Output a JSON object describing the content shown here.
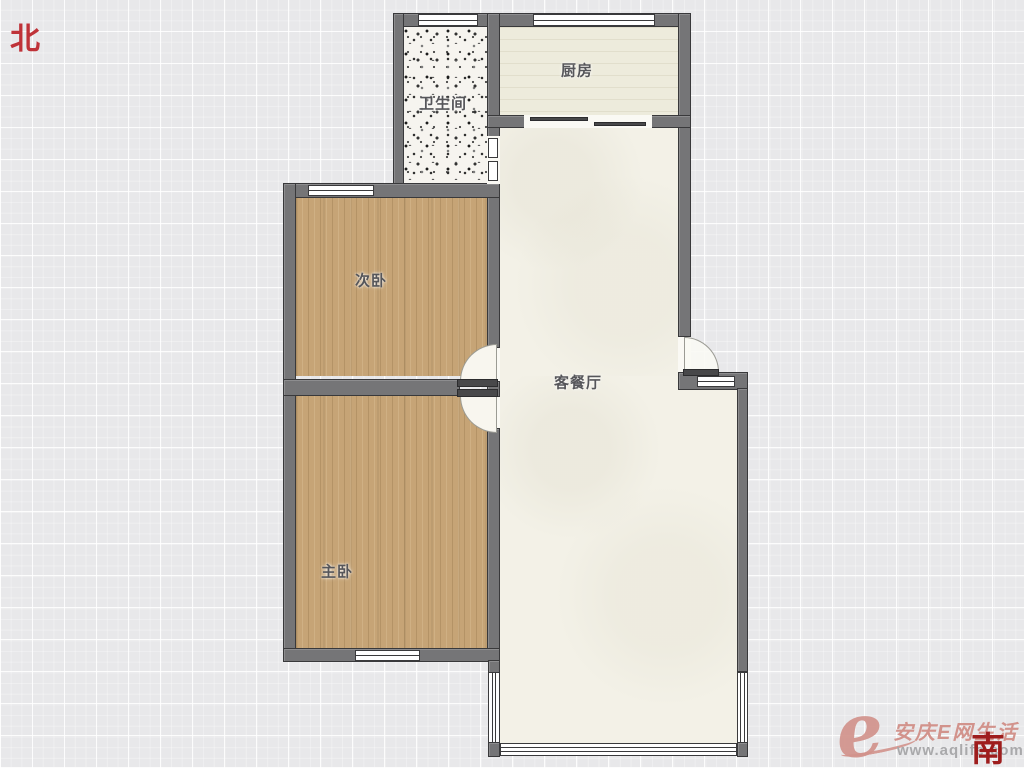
{
  "compass": {
    "north": "北",
    "south": "南"
  },
  "rooms": [
    {
      "id": "bathroom",
      "label": "卫生间"
    },
    {
      "id": "kitchen",
      "label": "厨房"
    },
    {
      "id": "second_bedroom",
      "label": "次卧"
    },
    {
      "id": "master_bedroom",
      "label": "主卧"
    },
    {
      "id": "living_dining",
      "label": "客餐厅"
    }
  ],
  "watermark": {
    "logo": "e",
    "brand": "安庆E网生活",
    "url": "www.aqlife.com"
  },
  "colors": {
    "wall": "#757577",
    "wall_border": "#39393b",
    "wood": "#c6a476",
    "kitchen": "#edebdc",
    "living": "#f3f1e7",
    "bath": "#f6f4ef",
    "grid_bg": "#e8e8ea",
    "accent_red": "#bf3238",
    "south_red": "#9e1d1d",
    "label": "#56565a",
    "wm_pink": "#d2938c",
    "wm_gray": "#a9a9ab"
  }
}
